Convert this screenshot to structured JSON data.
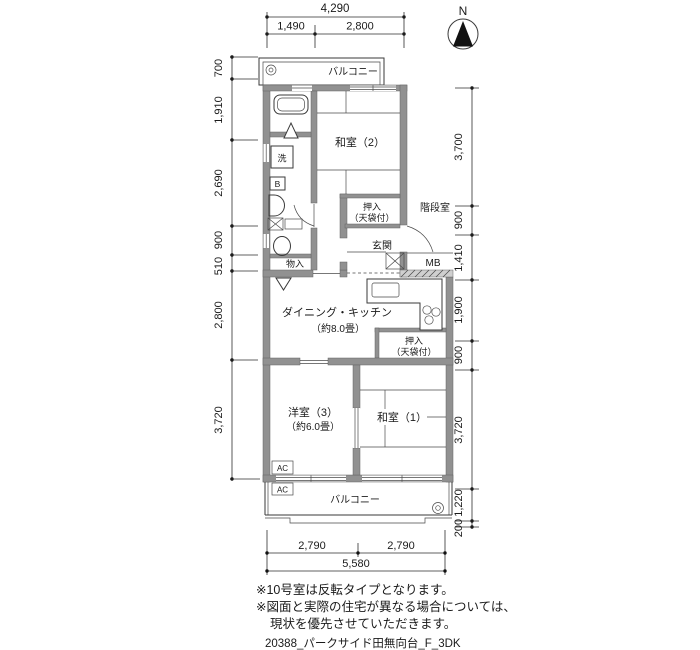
{
  "compass": {
    "label": "N"
  },
  "dimensions": {
    "top": {
      "total": "4,290",
      "left": "1,490",
      "right": "2,800"
    },
    "bottom": {
      "left": "2,790",
      "right": "2,790",
      "total": "5,580"
    },
    "left": [
      "700",
      "1,910",
      "2,690",
      "900",
      "510",
      "2,800",
      "3,720"
    ],
    "right": [
      "3,700",
      "900",
      "1,410",
      "1,900",
      "900",
      "3,720",
      "1,220",
      "200"
    ]
  },
  "labels": {
    "balcony_top": "バルコニー",
    "balcony_bottom": "バルコニー",
    "washitsu2": "和室（2）",
    "washitsu1": "和室（1）",
    "youshitsu3_name": "洋室（3）",
    "youshitsu3_size": "（約6.0畳）",
    "dk_name": "ダイニング・キッチン",
    "dk_size": "（約8.0畳）",
    "oshiire": "押入",
    "oshiire_note": "（天袋付）",
    "genkan": "玄関",
    "kaidanshitsu": "階段室",
    "monoire": "物入",
    "mb": "MB",
    "laundry": "洗",
    "bath_mark": "B",
    "ac": "AC"
  },
  "notes": {
    "line1": "※10号室は反転タイプとなります。",
    "line2": "※図面と実際の住宅が異なる場合については、",
    "line3": "現状を優先させていただきます。"
  },
  "footer": "20388_パークサイド田無向台_F_3DK",
  "colors": {
    "wall": "#919191",
    "line": "#3a3a3a",
    "background": "#ffffff"
  }
}
